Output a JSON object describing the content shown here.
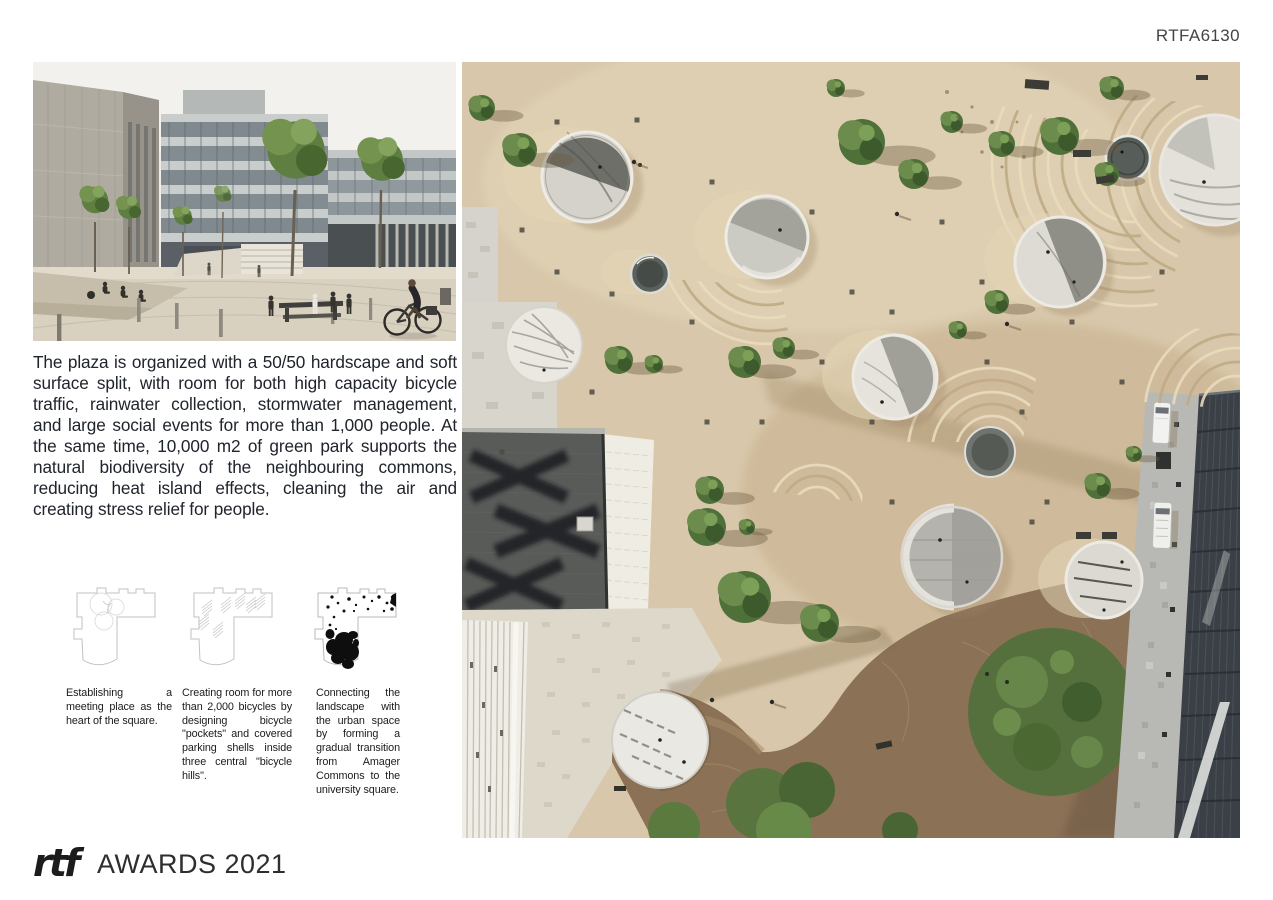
{
  "page": {
    "code": "RTFA6130"
  },
  "intro": {
    "paragraph": "The plaza is organized with a 50/50 hardscape and soft surface split, with room for both high capacity bicycle traffic, rainwater collection, stormwater management, and large social events for more than 1,000 people. At the same time, 10,000 m2 of green park supports the natural biodiversity of the neighbouring commons, reducing heat island effects, cleaning the air and creating stress relief for people."
  },
  "diagrams": [
    {
      "caption": "Establishing a meeting place as the heart of the square."
    },
    {
      "caption": "Creating room for more than 2,000 bicycles by designing bicycle \"pockets\" and covered parking shells inside three central \"bicycle hills\"."
    },
    {
      "caption": "Connecting the landscape with the urban space by forming a gradual transition from Amager Commons to the university square."
    }
  ],
  "footer": {
    "logo_mark": "rtf",
    "logo_text": "AWARDS 2021"
  },
  "palette": {
    "plaza_beige": "#d8c7aa",
    "park_brown": "#8b7156",
    "foliage_green": "#55703c",
    "concrete_grey": "#c9c8c1",
    "dark_facade": "#3a4046",
    "text_dark": "#20242c"
  }
}
